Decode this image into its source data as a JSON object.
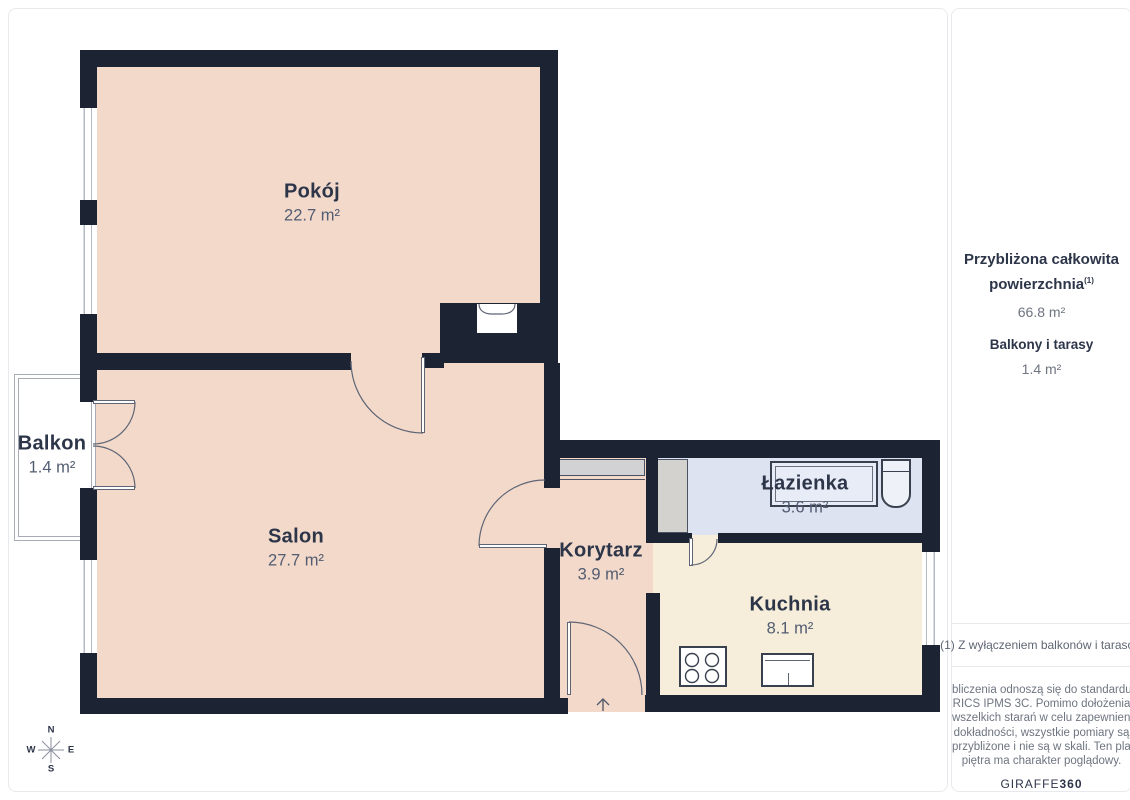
{
  "plan": {
    "rooms": {
      "pokoj": {
        "name": "Pokój",
        "area": "22.7 m²"
      },
      "salon": {
        "name": "Salon",
        "area": "27.7 m²"
      },
      "korytarz": {
        "name": "Korytarz",
        "area": "3.9 m²"
      },
      "lazienka": {
        "name": "Łazienka",
        "area": "3.6 m²"
      },
      "kuchnia": {
        "name": "Kuchnia",
        "area": "8.1 m²"
      },
      "balkon": {
        "name": "Balkon",
        "area": "1.4 m²"
      }
    },
    "compass": {
      "n": "N",
      "e": "E",
      "s": "S",
      "w": "W"
    }
  },
  "sidebar": {
    "total_label_line1": "Przybliżona całkowita",
    "total_label_line2": "powierzchnia",
    "total_superscript": "(1)",
    "total_value": "66.8 m²",
    "balcony_label": "Balkony i tarasy",
    "balcony_value": "1.4 m²",
    "footnote": "(1) Z wyłączeniem balkonów i tarasów",
    "disclaimer_lines": [
      "bliczenia odnoszą się do standardu",
      "RICS IPMS 3C. Pomimo dołożenia",
      "wszelkich starań w celu zapewnienia",
      "dokładności, wszystkie pomiary są",
      "przybliżone i nie są w skali. Ten plan",
      "piętra ma charakter poglądowy."
    ],
    "brand_regular": "GIRAFFE",
    "brand_bold": "360"
  },
  "colors": {
    "wall": "#1c2433",
    "room_floor": "#f2d9ca",
    "kitchen_floor": "#f6edda",
    "bathroom_floor": "#dde3f0",
    "label_text": "#2d3549",
    "area_text": "#525c72"
  }
}
